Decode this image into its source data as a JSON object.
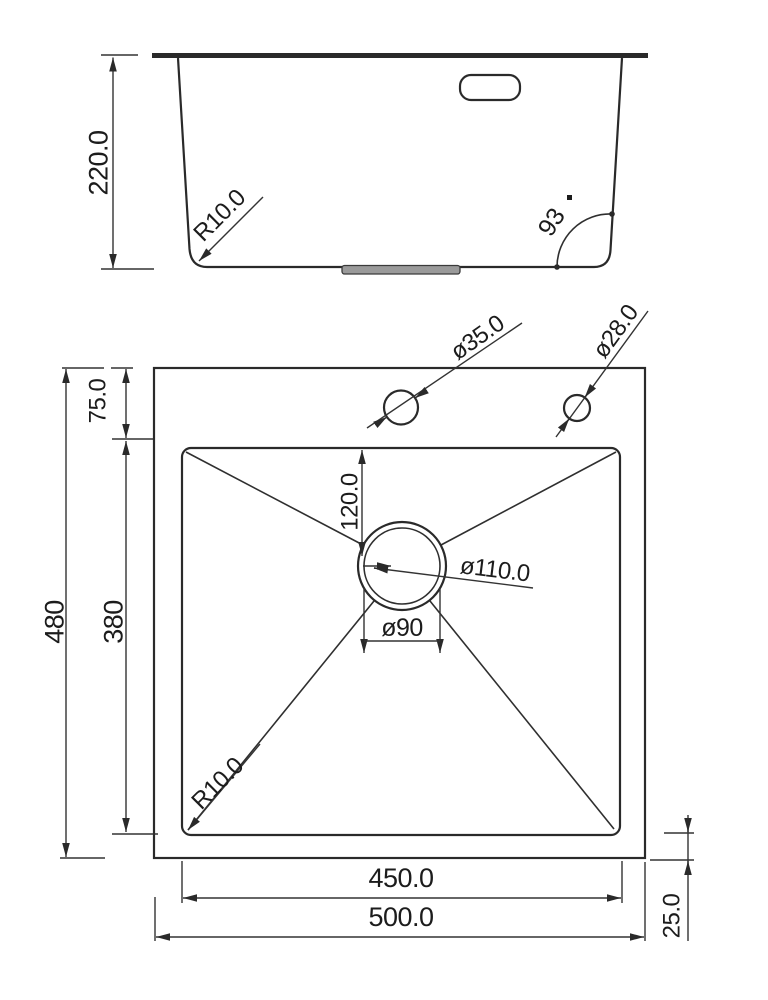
{
  "drawing": {
    "colors": {
      "line": "#2a2a2a",
      "dimension_line": "#333333",
      "text": "#1c1c1c",
      "drain_strip_fill": "#9a9a9a",
      "background": "#ffffff"
    },
    "elevation": {
      "depth_label": "220.0",
      "corner_radius_label": "R10.0",
      "wall_angle_label": "93"
    },
    "plan": {
      "overall_length_label": "480",
      "bowl_length_label": "380",
      "rim_top_label": "75.0",
      "faucet_hole_label": "ø35.0",
      "accessory_hole_label": "ø28.0",
      "drain_offset_label": "120.0",
      "drain_outer_diameter_label": "ø110.0",
      "drain_diameter_label": "ø90",
      "corner_radius_label": "R10.0",
      "bowl_width_label": "450.0",
      "overall_width_label": "500.0",
      "rim_bottom_label": "25.0"
    }
  }
}
